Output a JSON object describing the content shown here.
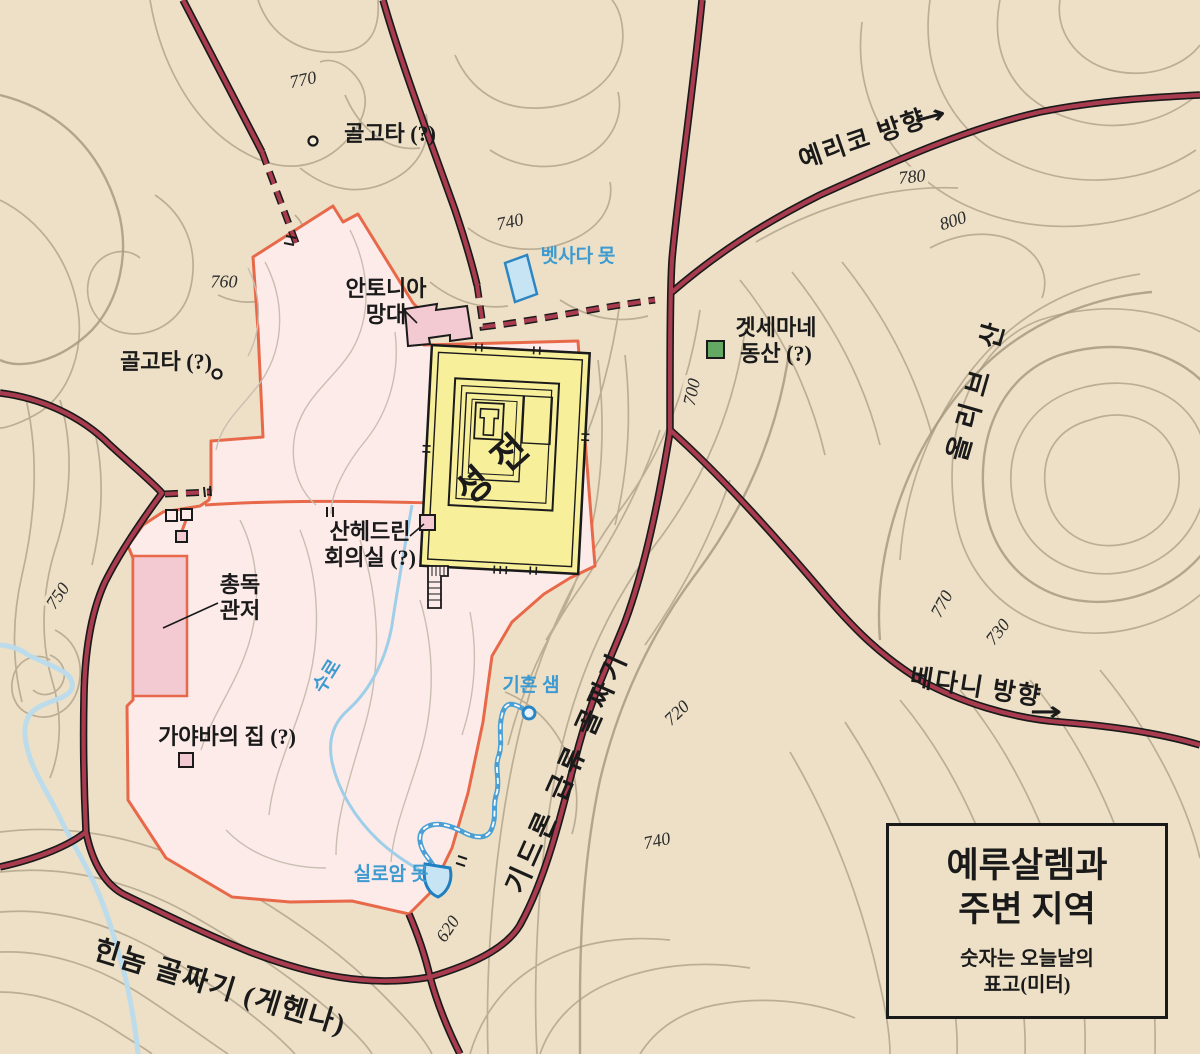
{
  "map": {
    "title_box": {
      "title_line1": "예루살렘과",
      "title_line2": "주변 지역",
      "subtitle_line1": "숫자는 오늘날의",
      "subtitle_line2": "표고(미터)"
    },
    "colors": {
      "background": "#ede0c6",
      "city_fill": "#fcebe9",
      "wall_stroke": "#e8694a",
      "temple_fill": "#f8ef9a",
      "building_fill": "#f3c9d2",
      "road": "#a93b4f",
      "water_fill": "#c6e4f4",
      "water_stroke": "#2d86c4",
      "water_label": "#3d9bd1",
      "gethsemane_green": "#63a963",
      "contour": "#b2a48c"
    },
    "place_labels": {
      "golgotha_north": "골고타 (?)",
      "golgotha_west": "골고타 (?)",
      "antonia_line1": "안토니아",
      "antonia_line2": "망대",
      "temple": "성전",
      "sanhedrin_line1": "산헤드린",
      "sanhedrin_line2": "회의실 (?)",
      "governor_line1": "총독",
      "governor_line2": "관저",
      "caiaphas": "가야바의 집 (?)",
      "gethsemane_line1": "겟세마네",
      "gethsemane_line2": "동산 (?)",
      "mount_olives": "올리브 산",
      "kidron_valley": "기드론 급류 골짜기",
      "hinnom_valley": "힌놈 골짜기 (게헨나)",
      "jericho_direction": "예리코 방향",
      "bethany_direction": "베다니 방향",
      "arrow_glyph": "→"
    },
    "water_labels": {
      "bethesda": "벳사다 못",
      "aqueduct": "수로",
      "gihon": "기혼 샘",
      "siloam": "실로암 못"
    },
    "elevation_labels": [
      {
        "value": "770"
      },
      {
        "value": "760"
      },
      {
        "value": "740"
      },
      {
        "value": "780"
      },
      {
        "value": "800"
      },
      {
        "value": "700"
      },
      {
        "value": "770"
      },
      {
        "value": "730"
      },
      {
        "value": "720"
      },
      {
        "value": "740"
      },
      {
        "value": "750"
      },
      {
        "value": "620"
      }
    ]
  }
}
